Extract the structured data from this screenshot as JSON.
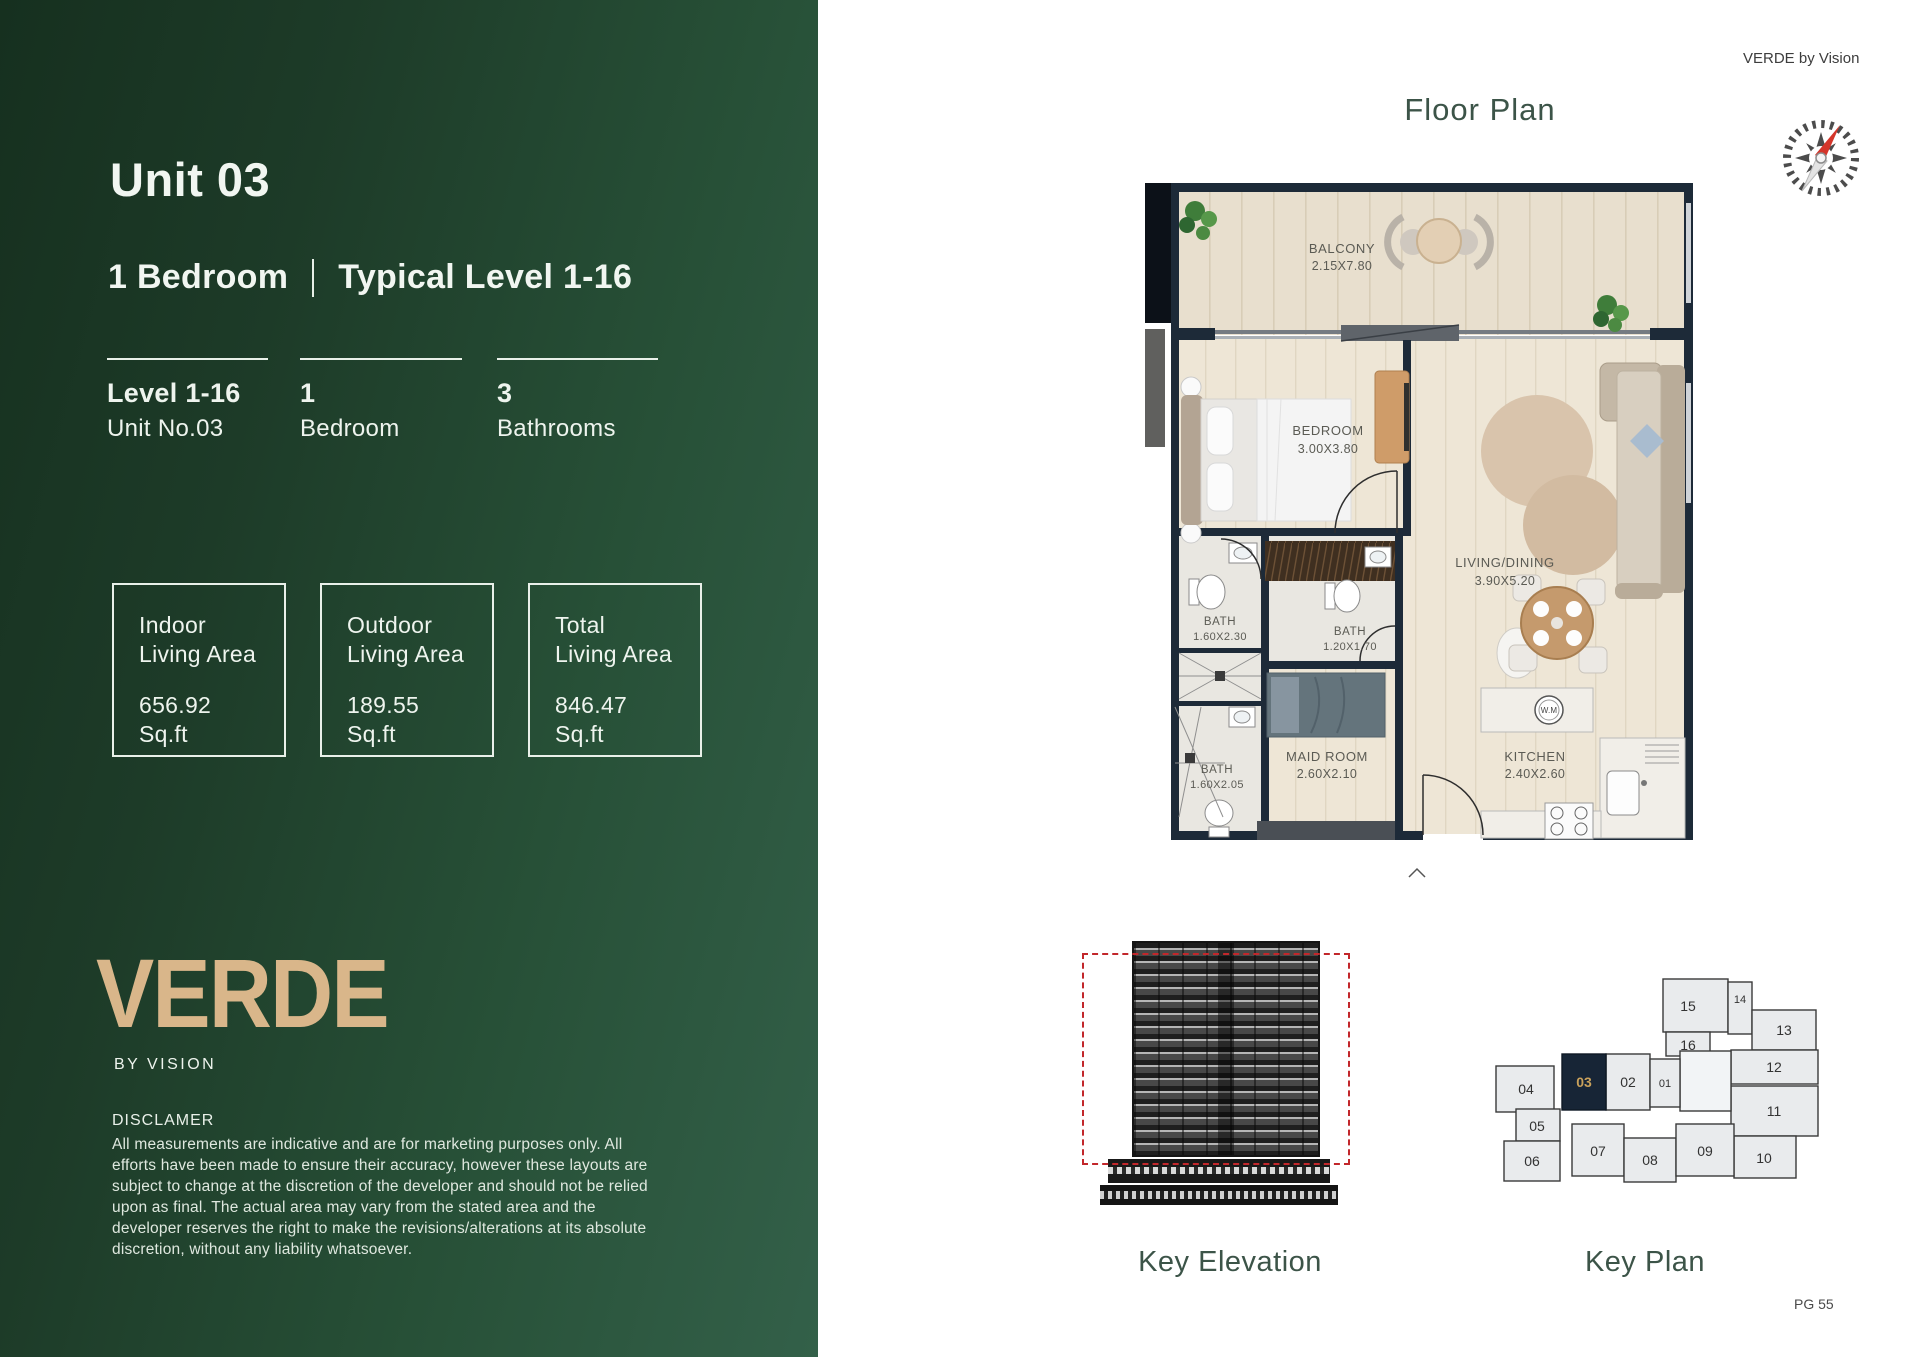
{
  "brand": {
    "logo": "VERDE",
    "tagline": "BY VISION",
    "watermark": "VERDE by Vision",
    "page_number": "PG 55"
  },
  "unit": {
    "title": "Unit 03",
    "type": "1 Bedroom",
    "levels": "Typical Level 1-16"
  },
  "stats": [
    {
      "value": "Level 1-16",
      "label": "Unit No.03"
    },
    {
      "value": "1",
      "label": "Bedroom"
    },
    {
      "value": "3",
      "label": "Bathrooms"
    }
  ],
  "areas": [
    {
      "line1": "Indoor",
      "line2": "Living Area",
      "value": "656.92",
      "unit": "Sq.ft"
    },
    {
      "line1": "Outdoor",
      "line2": "Living Area",
      "value": "189.55",
      "unit": "Sq.ft"
    },
    {
      "line1": "Total",
      "line2": "Living Area",
      "value": "846.47",
      "unit": "Sq.ft"
    }
  ],
  "disclaimer": {
    "title": "DISCLAMER",
    "body": "All measurements are indicative and are for marketing purposes only. All efforts have been made to ensure their accuracy, however these layouts are subject to change at the discretion of the developer and should not be relied upon as final. The actual area may vary from the stated area and the developer reserves the right to make the revisions/alterations at its absolute discretion, without any liability whatsoever."
  },
  "floor_plan": {
    "title": "Floor Plan",
    "rooms": [
      {
        "name": "BALCONY",
        "dims": "2.15X7.80"
      },
      {
        "name": "BEDROOM",
        "dims": "3.00X3.80"
      },
      {
        "name": "LIVING/DINING",
        "dims": "3.90X5.20"
      },
      {
        "name": "BATH",
        "dims": "1.60X2.30"
      },
      {
        "name": "BATH",
        "dims": "1.20X1.70"
      },
      {
        "name": "MAID ROOM",
        "dims": "2.60X2.10"
      },
      {
        "name": "KITCHEN",
        "dims": "2.40X2.60"
      },
      {
        "name": "BATH",
        "dims": "1.60X2.05"
      },
      {
        "name": "W.M",
        "dims": ""
      }
    ]
  },
  "key_elevation": {
    "label": "Key Elevation"
  },
  "key_plan": {
    "label": "Key Plan",
    "highlighted_unit": "03",
    "units": [
      {
        "label": "01"
      },
      {
        "label": "02"
      },
      {
        "label": "03"
      },
      {
        "label": "04"
      },
      {
        "label": "05"
      },
      {
        "label": "06"
      },
      {
        "label": "07"
      },
      {
        "label": "08"
      },
      {
        "label": "09"
      },
      {
        "label": "10"
      },
      {
        "label": "11"
      },
      {
        "label": "12"
      },
      {
        "label": "13"
      },
      {
        "label": "14"
      },
      {
        "label": "15"
      },
      {
        "label": "16"
      }
    ]
  },
  "colors": {
    "panel_dark": "#16301f",
    "panel_light": "#336049",
    "logo_gold": "#d9b68a",
    "heading_green": "#3c5448",
    "wall_navy": "#1d2a38",
    "floor_tan": "#e8dfce",
    "red_dashed": "#c2272b",
    "keyplan_highlight_bg": "#172536",
    "keyplan_highlight_text": "#c9a15b"
  }
}
